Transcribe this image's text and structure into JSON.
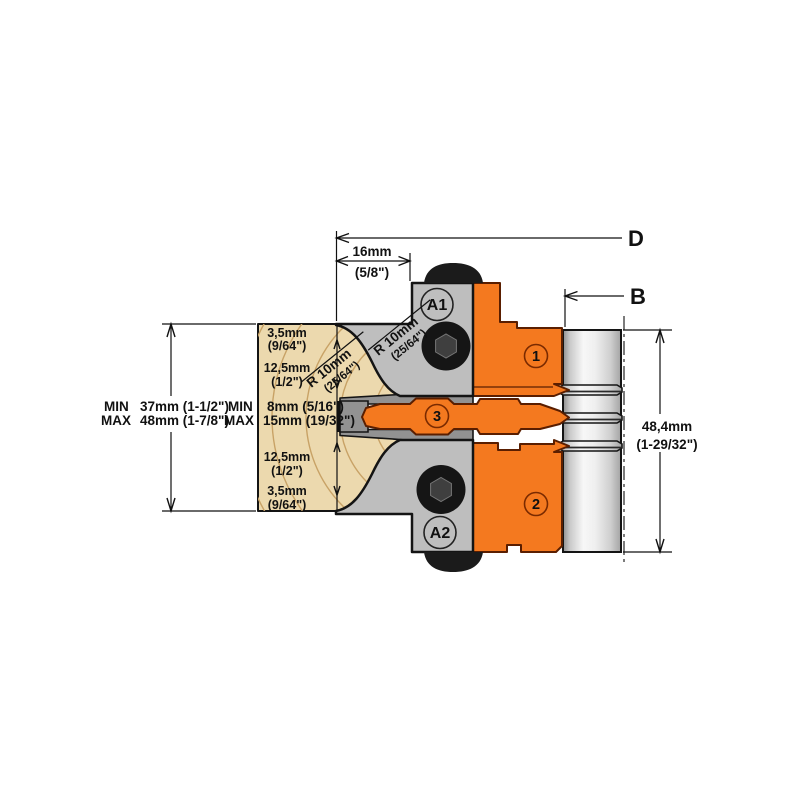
{
  "colors": {
    "orange": "#F4791F",
    "orange_outline": "#5A1E00",
    "body_gray": "#BEBEBE",
    "clamp_gray": "#929292",
    "wood": "#ECD9AE",
    "wood_grain": "#C8A266",
    "outline": "#141414",
    "steel_dark": "#8E8E8E",
    "steel_light": "#F7F7F7"
  },
  "dims": {
    "d_label": "D",
    "b_label": "B",
    "top_width_mm": "16mm",
    "top_width_in": "(5/8\")",
    "shaft_height_mm": "48,4mm",
    "shaft_height_in": "(1-29/32\")"
  },
  "stock": {
    "min_label": "MIN",
    "min_value": "37mm (1-1/2\")",
    "max_label": "MAX",
    "max_value": "48mm (1-7/8\")"
  },
  "tongue": {
    "min_label": "MIN",
    "min_value": "8mm (5/16\")",
    "max_label": "MAX",
    "max_value": "15mm (19/32\")"
  },
  "profile": {
    "top_small_mm": "3,5mm",
    "top_small_in": "(9/64\")",
    "top_mid_mm": "12,5mm",
    "top_mid_in": "(1/2\")",
    "bottom_mid_mm": "12,5mm",
    "bottom_mid_in": "(1/2\")",
    "bottom_small_mm": "3,5mm",
    "bottom_small_in": "(9/64\")"
  },
  "radius_upper": {
    "mm": "R 10mm",
    "in": "(25/64\")"
  },
  "radius_lower": {
    "mm": "R 10mm",
    "in": "(25/64\")"
  },
  "parts": {
    "a1": "A1",
    "a2": "A2",
    "knife1": "1",
    "knife2": "2",
    "knife3": "3"
  }
}
